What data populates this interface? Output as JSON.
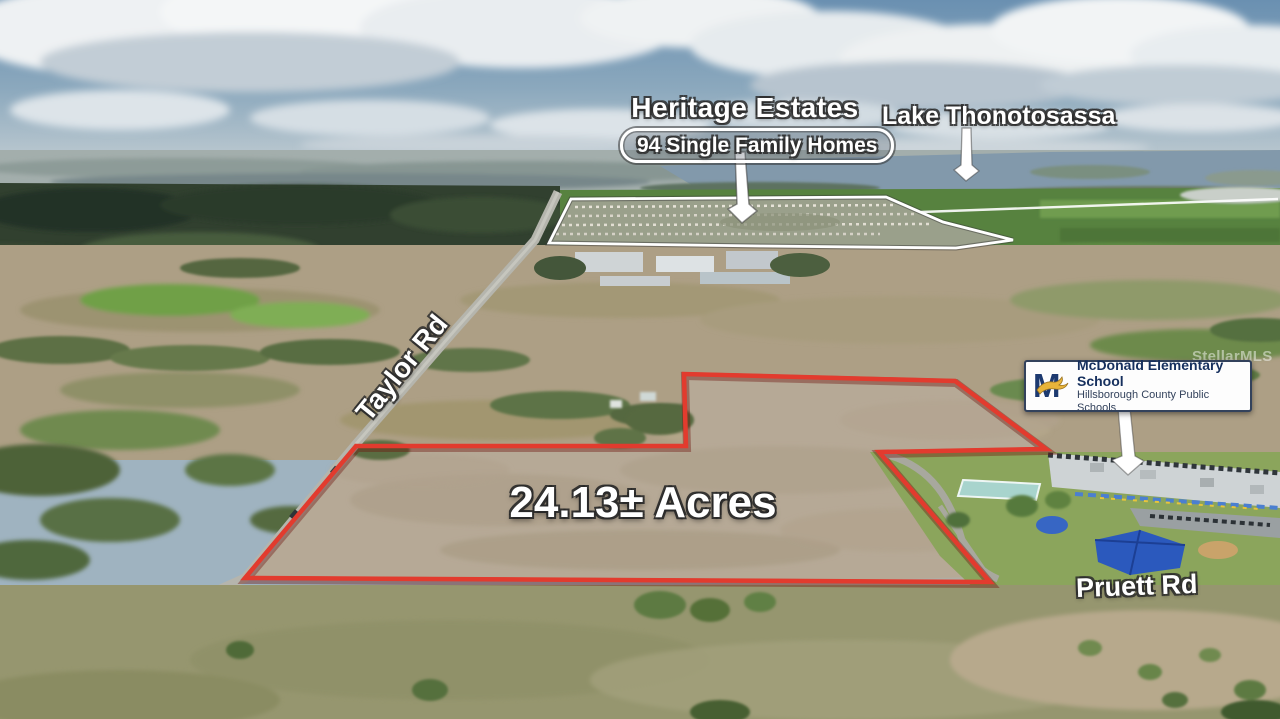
{
  "annotations": {
    "heritage_estates": {
      "title": "Heritage Estates",
      "subtitle": "94 Single Family Homes"
    },
    "lake_label": "Lake Thonotosassa",
    "acreage_label": "24.13± Acres",
    "taylor_road_label": "Taylor Rd",
    "pruett_road_label": "Pruett Rd",
    "school_card": {
      "logo_letter": "M",
      "name": "McDonald Elementary School",
      "district": "Hillsborough County Public Schools"
    },
    "watermark": "StellarMLS"
  },
  "colors": {
    "parcel_outline_red": "#e23b2e",
    "annotation_white": "#ffffff",
    "school_navy": "#1d3a70",
    "school_gold": "#e8b43a",
    "canopy_blue": "#2b59bd",
    "lake_blue": "#8299ab"
  }
}
